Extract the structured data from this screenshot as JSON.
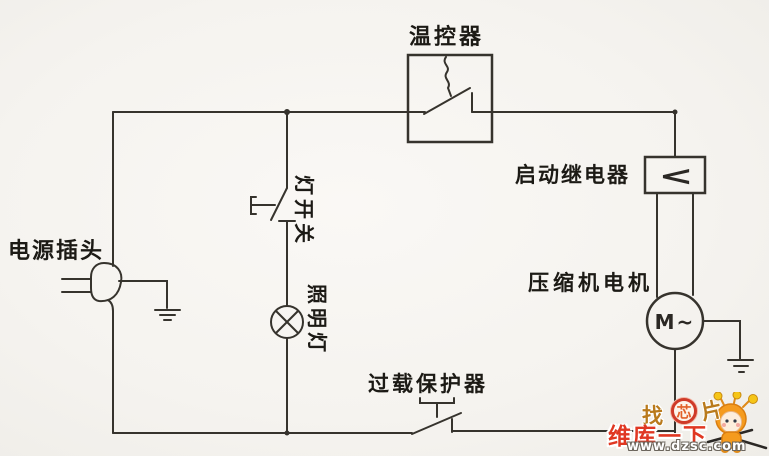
{
  "diagram": {
    "labels": {
      "thermostat": "温控器",
      "start_relay": "启动继电器",
      "compressor_motor": "压缩机电机",
      "power_plug": "电源插头",
      "light_switch": "灯开关",
      "lighting_lamp": "照明灯",
      "overload_protector": "过载保护器"
    },
    "symbols": {
      "motor": "M~",
      "relay": "<"
    },
    "colors": {
      "background": "#f4f2ee",
      "wire": "#36332d",
      "label_text": "#1c1a15"
    }
  },
  "watermark": {
    "logo": {
      "left_char": "找",
      "center_char": "芯",
      "right_char": "片"
    },
    "brand": "维库一下",
    "url": "www.dzsc.com",
    "colors": {
      "brand_red": "#e03722",
      "logo_gold": "#b97a1c",
      "mascot_orange": "#f59b1e"
    }
  }
}
